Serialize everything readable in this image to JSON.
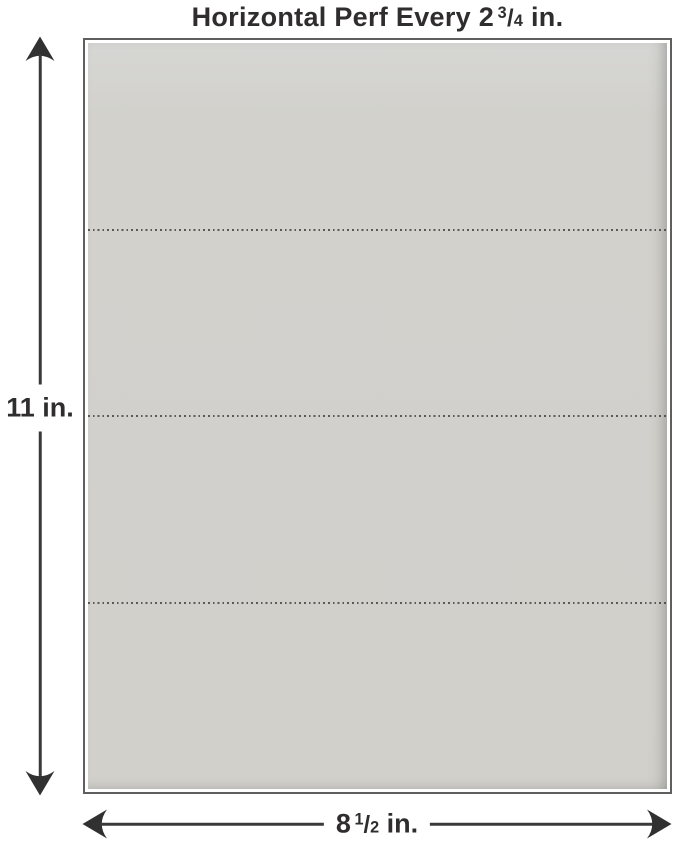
{
  "title": {
    "prefix": "Horizontal Perf Every 2",
    "fraction": {
      "numerator": "3",
      "denominator": "4"
    },
    "suffix": "in."
  },
  "sheet": {
    "perforations": {
      "count": 3,
      "positions_fraction": [
        0.25,
        0.5,
        0.75
      ]
    }
  },
  "dimensions": {
    "height": {
      "label": "11 in."
    },
    "width": {
      "prefix": "8",
      "fraction": {
        "numerator": "1",
        "denominator": "2"
      },
      "suffix": "in."
    }
  },
  "colors": {
    "background": "#ffffff",
    "paper": "#d2d1cc",
    "border": "#5f5f5f",
    "arrow": "#3a3a3a",
    "text": "#2f2d2e",
    "perforation": "#444444"
  }
}
